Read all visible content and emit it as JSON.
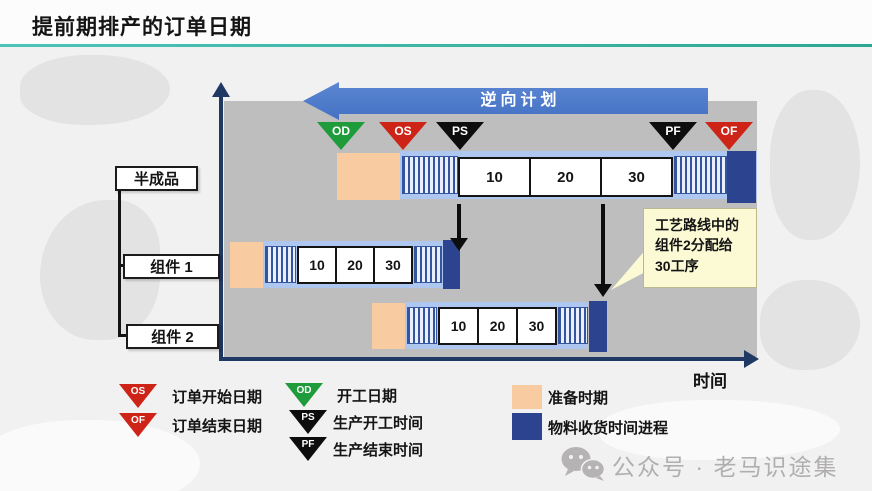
{
  "page": {
    "title": "提前期排产的订单日期",
    "watermark": "公众号 · 老马识途集"
  },
  "diagram": {
    "reverse_plan_label": "逆向计划",
    "time_axis_label": "时间",
    "markers": [
      {
        "code": "OD",
        "color": "#1E9C3C"
      },
      {
        "code": "OS",
        "color": "#CE2418"
      },
      {
        "code": "PS",
        "color": "#0D0D0D"
      },
      {
        "code": "PF",
        "color": "#0D0D0D"
      },
      {
        "code": "OF",
        "color": "#CE2418"
      }
    ],
    "rows": [
      {
        "label": "半成品",
        "ops": [
          "10",
          "20",
          "30"
        ]
      },
      {
        "label": "组件 1",
        "ops": [
          "10",
          "20",
          "30"
        ]
      },
      {
        "label": "组件 2",
        "ops": [
          "10",
          "20",
          "30"
        ]
      }
    ],
    "callout_text": "工艺路线中的组件2分配给30工序"
  },
  "legend": {
    "items": [
      {
        "code": "OS",
        "label": "订单开始日期"
      },
      {
        "code": "OF",
        "label": "订单结束日期"
      },
      {
        "code": "OD",
        "label": "开工日期"
      },
      {
        "code": "PS",
        "label": "生产开工时间"
      },
      {
        "code": "PF",
        "label": "生产结束时间"
      },
      {
        "label": "准备时期"
      },
      {
        "label": "物料收货时间进程"
      }
    ]
  },
  "colors": {
    "accent_teal": "#35B1A2",
    "arrow_blue": "#4472C4",
    "panel_gray": "#BEBEBE",
    "bar_blue": "#ADC7F0",
    "prep_orange": "#F9CBA0",
    "material_navy": "#2C4390",
    "marker_green": "#1E9C3C",
    "marker_red": "#CE2418",
    "marker_black": "#0D0D0D",
    "axis_navy": "#203864",
    "callout_yellow": "#FBFAD4"
  }
}
